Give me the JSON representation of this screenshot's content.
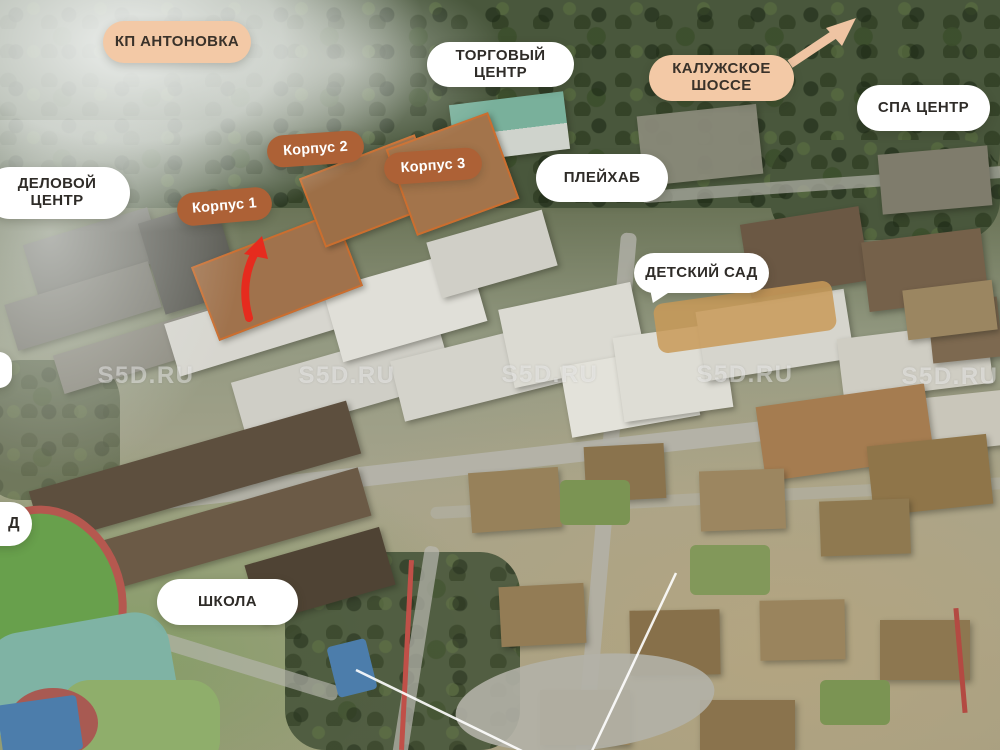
{
  "labels": {
    "kp_antonovka": {
      "text": "КП АНТОНОВКА"
    },
    "torgovy_center": {
      "line1": "ТОРГОВЫЙ",
      "line2": "ЦЕНТР"
    },
    "kaluzhskoe_shosse": {
      "line1": "КАЛУЖСКОЕ",
      "line2": "ШОССЕ"
    },
    "spa_center": {
      "text": "СПА ЦЕНТР"
    },
    "delovoy_center": {
      "line1": "ДЕЛОВОЙ",
      "line2": "ЦЕНТР"
    },
    "playhub": {
      "text": "ПЛЕЙХАБ"
    },
    "korpus_1": {
      "text": "Корпус 1"
    },
    "korpus_2": {
      "text": "Корпус 2"
    },
    "korpus_3": {
      "text": "Корпус 3"
    },
    "detsky_sad": {
      "text": "ДЕТСКИЙ САД"
    },
    "shkola": {
      "text": "ШКОЛА"
    },
    "edge_partial": {
      "text": "Д"
    }
  },
  "watermark": {
    "text": "S5D.RU"
  },
  "colors": {
    "peach_label": "#f3c9a6",
    "brown_label": "#ad6136",
    "white_label": "#ffffff",
    "red_arrow": "#e62b1e",
    "peach_arrow": "#efc4a3"
  }
}
